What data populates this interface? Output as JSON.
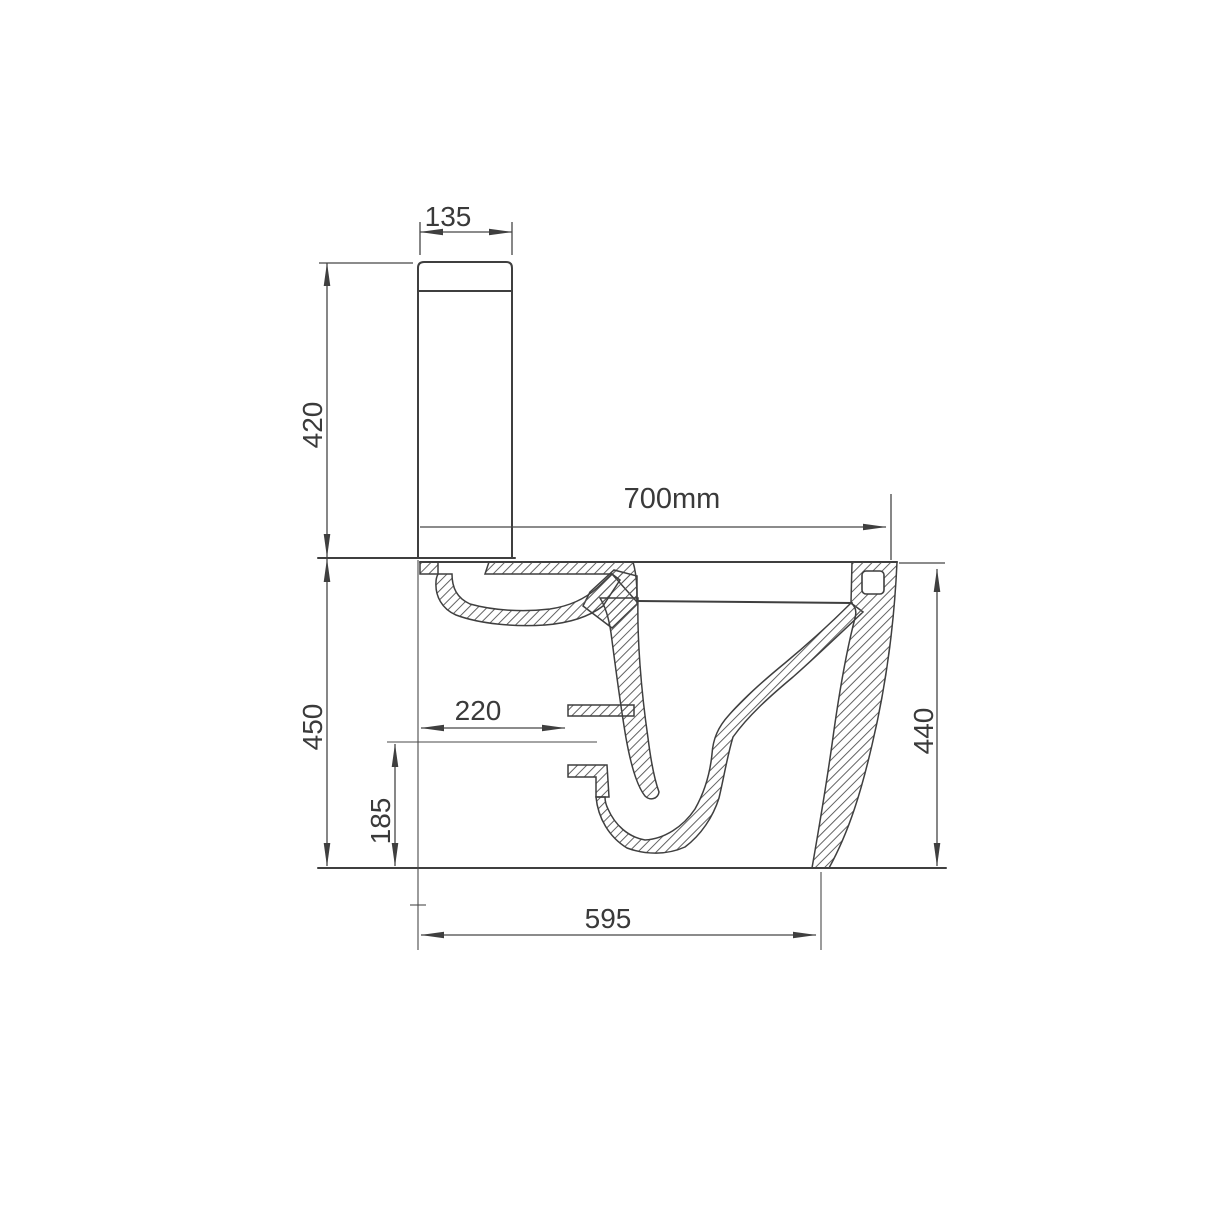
{
  "drawing": {
    "type": "technical-drawing",
    "subject": "close-coupled toilet side cross-section with dimensions",
    "unit": "mm",
    "labels": {
      "cistern_width": "135",
      "cistern_height": "420",
      "overall_depth": "700mm",
      "pan_height": "450",
      "outlet_setback": "220",
      "outlet_height": "185",
      "rear_height": "440",
      "base_depth": "595"
    },
    "colors": {
      "background": "#ffffff",
      "line": "#3f3f3f",
      "hatch": "#5a5a5a",
      "text": "#3a3a3a"
    }
  }
}
